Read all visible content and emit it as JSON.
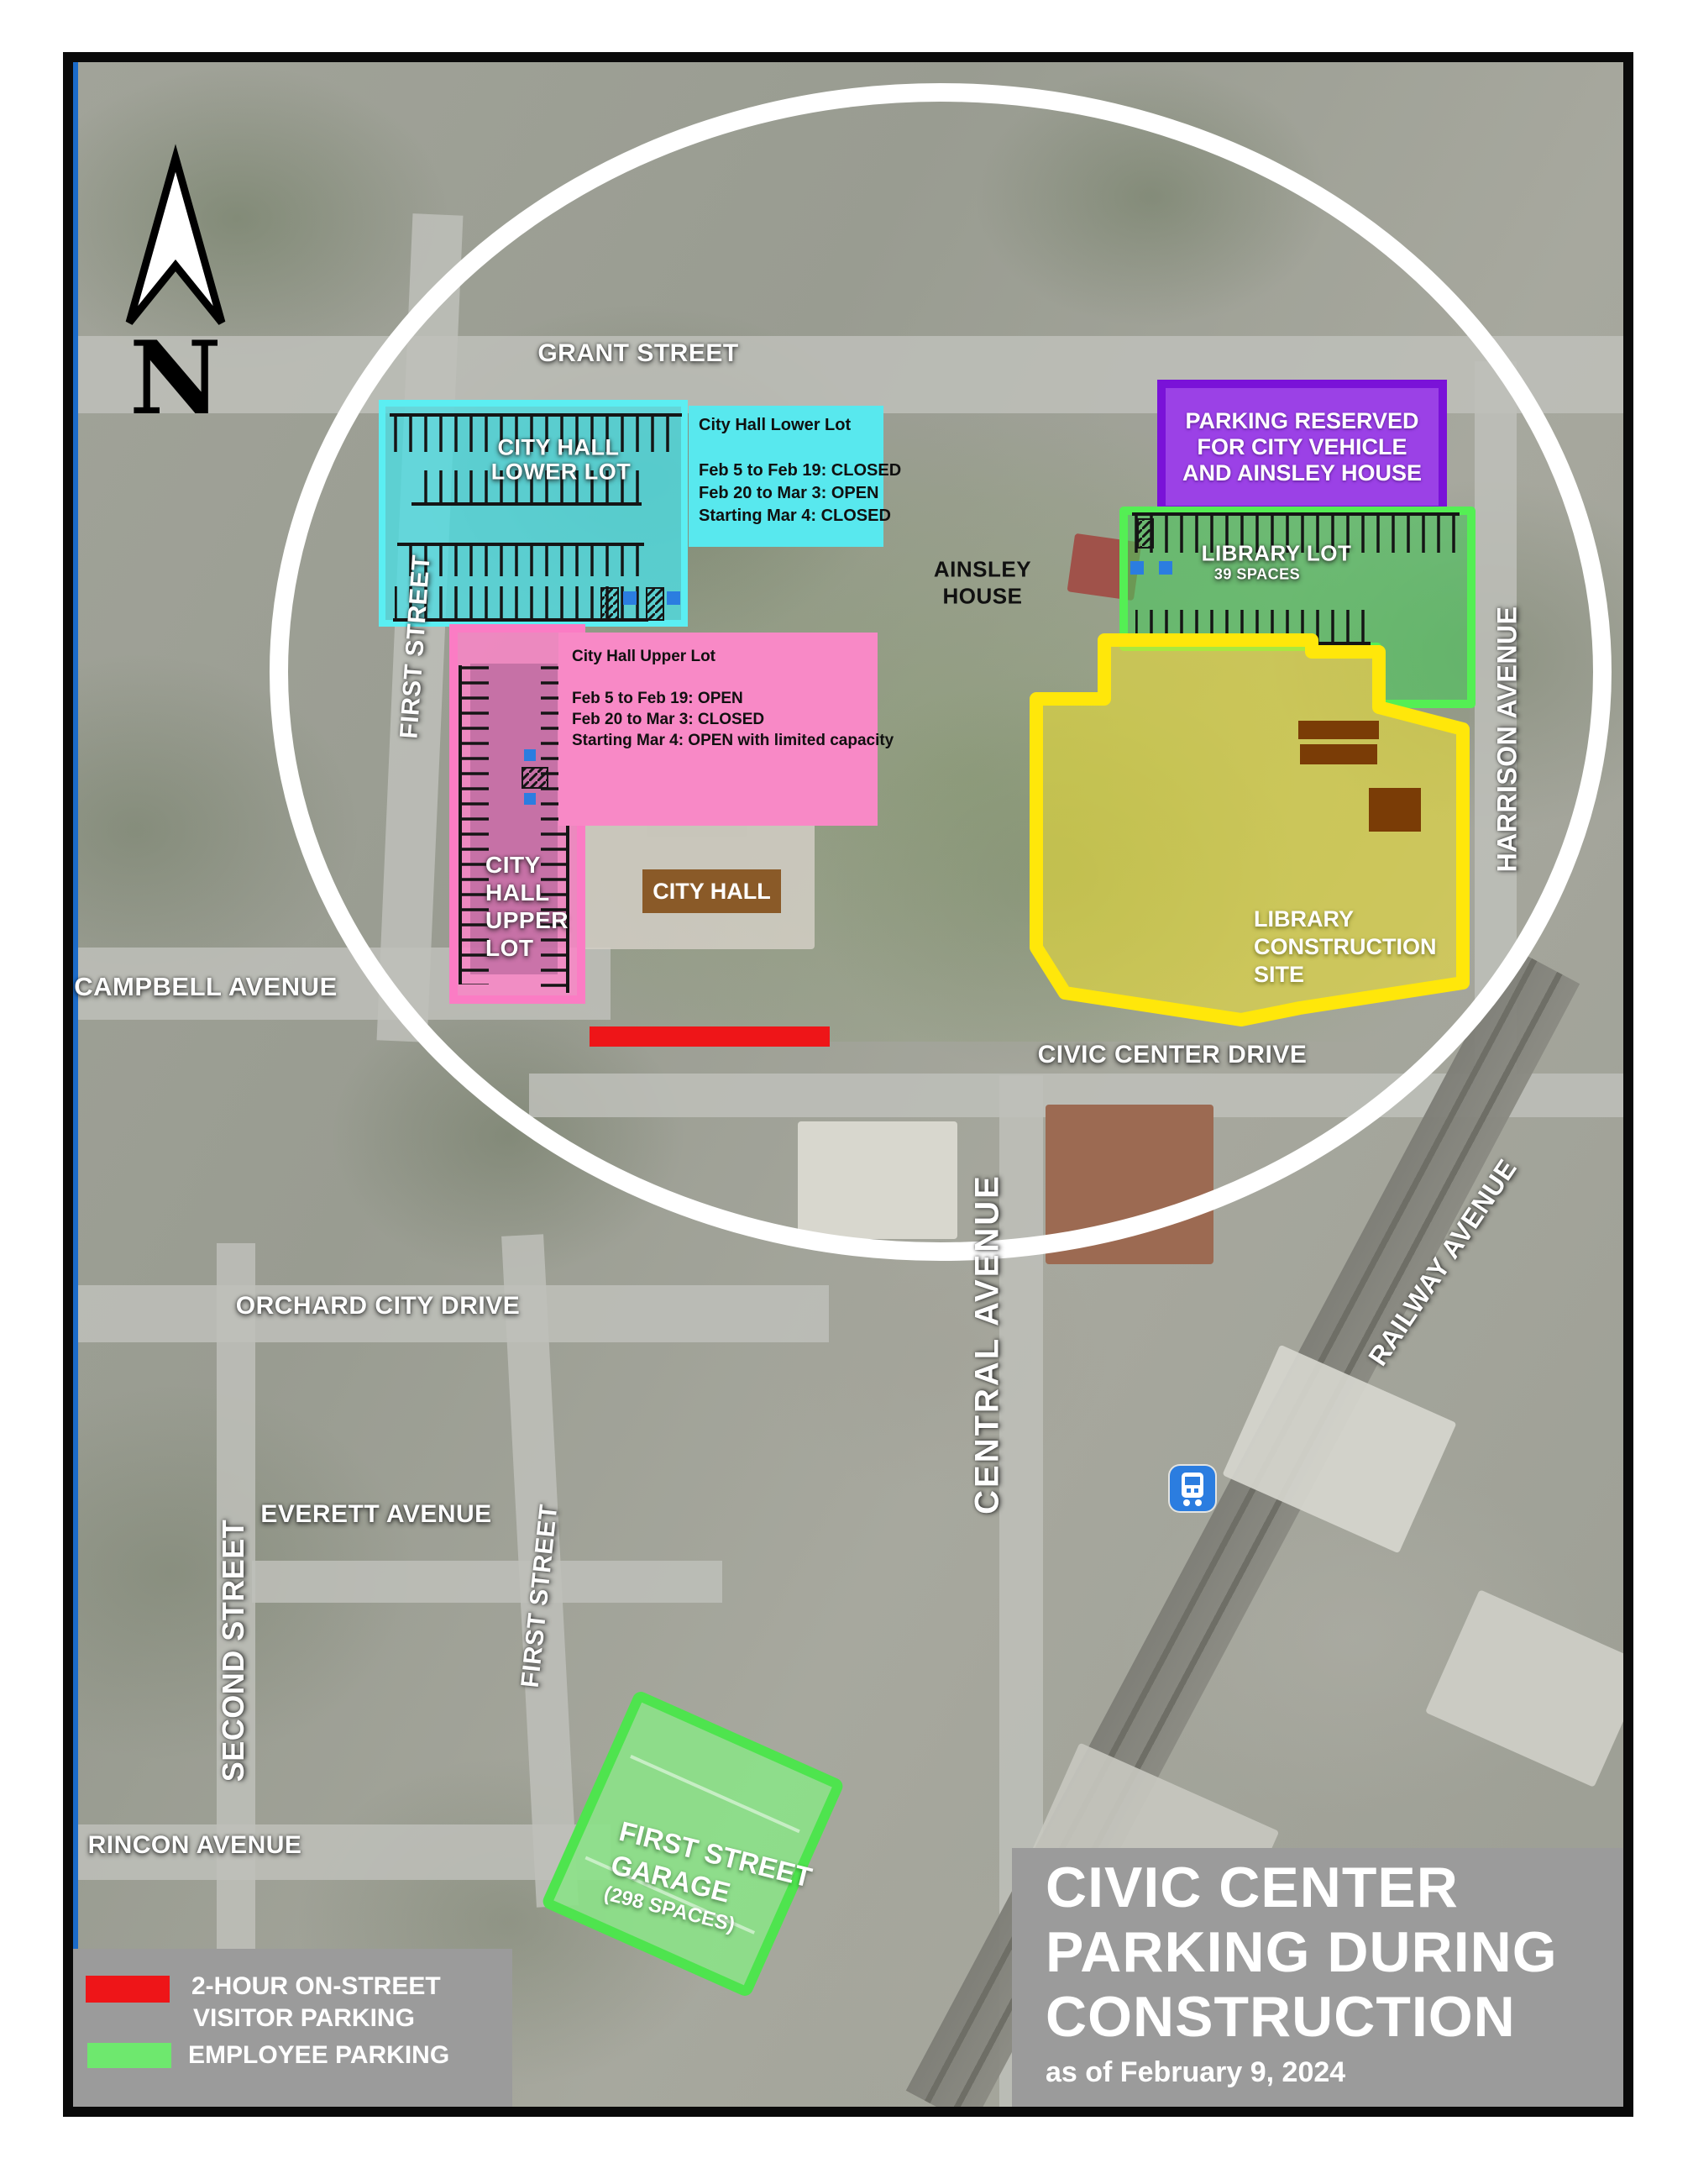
{
  "north": {
    "label": "N"
  },
  "streets": {
    "grant": "GRANT STREET",
    "first_upper": "FIRST STREET",
    "campbell": "CAMPBELL AVENUE",
    "civic_center": "CIVIC CENTER DRIVE",
    "central": "CENTRAL AVENUE",
    "harrison": "HARRISON AVENUE",
    "railway": "RAILWAY AVENUE",
    "orchard": "ORCHARD CITY DRIVE",
    "second": "SECOND STREET",
    "first_lower": "FIRST STREET",
    "everett": "EVERETT AVENUE",
    "rincon": "RINCON AVENUE"
  },
  "landmarks": {
    "city_hall": "CITY HALL",
    "ainsley": {
      "line1": "AINSLEY",
      "line2": "HOUSE"
    }
  },
  "lots": {
    "city_hall_lower": {
      "label_line1": "CITY HALL",
      "label_line2": "LOWER LOT",
      "info_title": "City Hall Lower Lot",
      "schedule": [
        "Feb 5 to Feb 19: CLOSED",
        "Feb 20 to Mar 3: OPEN",
        "Starting Mar 4: CLOSED"
      ]
    },
    "city_hall_upper": {
      "label_lines": [
        "CITY",
        "HALL",
        "UPPER",
        "LOT"
      ],
      "info_title": "City Hall Upper Lot",
      "schedule": [
        "Feb 5 to Feb 19: OPEN",
        "Feb 20 to Mar 3: CLOSED",
        "Starting Mar 4: OPEN with limited capacity"
      ]
    },
    "reserved_purple": {
      "lines": [
        "PARKING RESERVED",
        "FOR CITY VEHICLE",
        "AND AINSLEY HOUSE"
      ]
    },
    "library_lot": {
      "name": "LIBRARY LOT",
      "spaces": "39 SPACES"
    },
    "library_construction": {
      "lines": [
        "LIBRARY",
        "CONSTRUCTION",
        "SITE"
      ]
    },
    "first_street_garage": {
      "line1": "FIRST STREET",
      "line2": "GARAGE",
      "spaces": "(298 SPACES)"
    }
  },
  "legend": {
    "visitor_line1": "2-HOUR ON-STREET",
    "visitor_line2": "VISITOR PARKING",
    "employee": "EMPLOYEE PARKING"
  },
  "title_box": {
    "line1": "CIVIC CENTER",
    "line2": "PARKING DURING",
    "line3": "CONSTRUCTION",
    "as_of": "as of February 9, 2024"
  },
  "colors": {
    "visitor_red": "#ee1518",
    "employee_green": "#6ee86e",
    "lower_lot_cyan": "#5ee9ef",
    "upper_lot_pink": "#f889c6",
    "reserved_purple": "#9b41e6",
    "library_lot_green": "#54ef54",
    "construction_yellow": "#ffe70a",
    "city_hall_brown": "#8a5a28",
    "panel_gray": "#9b9b9b",
    "train_blue": "#2b7de0"
  }
}
